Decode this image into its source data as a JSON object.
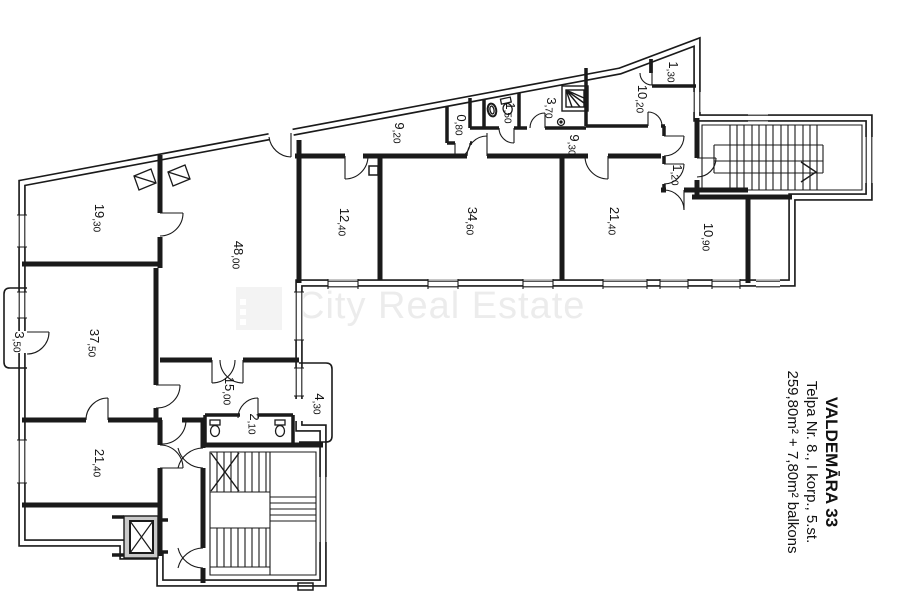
{
  "watermark": {
    "text": "City Real Estate",
    "logo": "city-real-estate-logo",
    "text_color": "#ececec",
    "logo_color": "#f3f3f3"
  },
  "title_block": {
    "address": "VALDEMĀRA 33",
    "unit": "Telpa Nr. 8., I korp., 5.st.",
    "area": "259,80m² + 7,80m² balkons"
  },
  "colors": {
    "line": "#1a1a1a",
    "background": "#ffffff"
  },
  "rooms": [
    {
      "id": "19-30",
      "label": "19,30",
      "x": 95,
      "y": 218
    },
    {
      "id": "48-00",
      "label": "48,00",
      "x": 234,
      "y": 255
    },
    {
      "id": "12-40",
      "label": "12,40",
      "x": 340,
      "y": 222
    },
    {
      "id": "34-60",
      "label": "34,60",
      "x": 468,
      "y": 221
    },
    {
      "id": "21-40-top",
      "label": "21,40",
      "x": 610,
      "y": 221
    },
    {
      "id": "10-90",
      "label": "10,90",
      "x": 704,
      "y": 237
    },
    {
      "id": "10-20",
      "label": "10,20",
      "x": 638,
      "y": 99
    },
    {
      "id": "1-30",
      "label": "1,30",
      "x": 669,
      "y": 72
    },
    {
      "id": "3-70",
      "label": "3,70",
      "x": 547,
      "y": 108
    },
    {
      "id": "1-50",
      "label": "1,50",
      "x": 506,
      "y": 113
    },
    {
      "id": "0-80",
      "label": "0,80",
      "x": 457,
      "y": 125
    },
    {
      "id": "9-20",
      "label": "9,20",
      "x": 395,
      "y": 133
    },
    {
      "id": "9-30",
      "label": "9,30",
      "x": 570,
      "y": 145
    },
    {
      "id": "1-20",
      "label": "1,20",
      "x": 673,
      "y": 175
    },
    {
      "id": "37-50",
      "label": "37,50",
      "x": 90,
      "y": 343
    },
    {
      "id": "3-50",
      "label": "3,50",
      "x": 15,
      "y": 342
    },
    {
      "id": "15-00",
      "label": "15,00",
      "x": 225,
      "y": 391
    },
    {
      "id": "2-10",
      "label": "2,10",
      "x": 250,
      "y": 424
    },
    {
      "id": "4-30",
      "label": "4,30",
      "x": 315,
      "y": 404
    },
    {
      "id": "21-40-bottom",
      "label": "21,40",
      "x": 95,
      "y": 463
    }
  ],
  "icons": [
    {
      "name": "toilet-icon",
      "x": 215,
      "y": 426
    },
    {
      "name": "toilet-icon",
      "x": 280,
      "y": 426
    },
    {
      "name": "toilet-icon",
      "x": 507,
      "y": 104
    },
    {
      "name": "sink-icon",
      "x": 492,
      "y": 110
    },
    {
      "name": "shower-icon",
      "x": 575,
      "y": 98
    },
    {
      "name": "drain-icon",
      "x": 561,
      "y": 122
    },
    {
      "name": "duct-icon",
      "x": 373,
      "y": 170
    },
    {
      "name": "vent-icon",
      "x": 145,
      "y": 179
    },
    {
      "name": "vent-icon",
      "x": 179,
      "y": 175
    },
    {
      "name": "elevator-icon",
      "x": 140,
      "y": 536
    },
    {
      "name": "staircase-icon",
      "x": 778,
      "y": 157
    },
    {
      "name": "staircase-icon",
      "x": 263,
      "y": 513
    }
  ]
}
